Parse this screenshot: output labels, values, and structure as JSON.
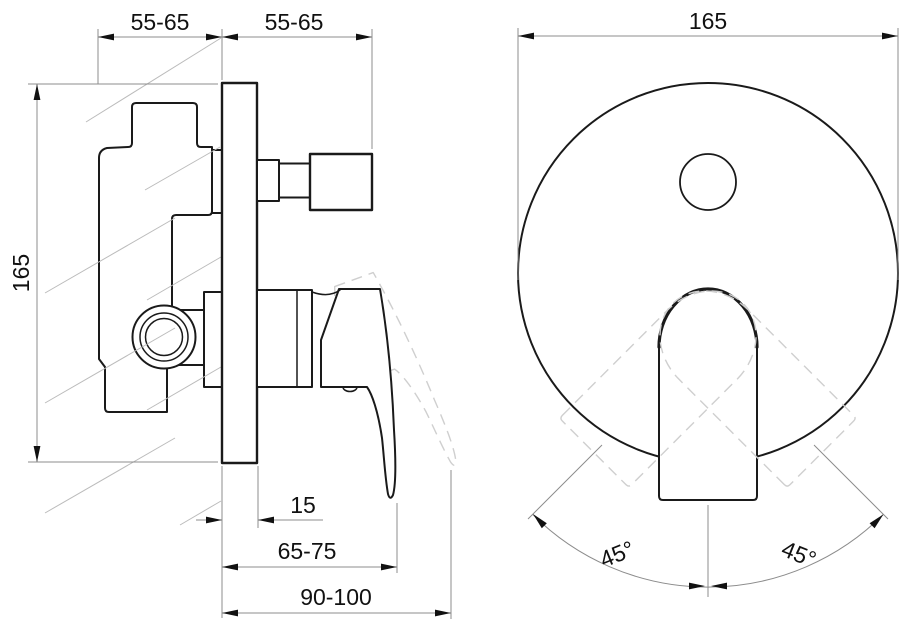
{
  "drawing": {
    "kind": "concealed-shower-mixer-installation-drawing",
    "side_view": {
      "dim_depth_behind_wall": "55-65",
      "dim_depth_in_front": "55-65",
      "dim_plate_height": "165",
      "dim_plate_offset": "15",
      "dim_lever_reach_closed": "65-75",
      "dim_lever_reach_open": "90-100"
    },
    "front_view": {
      "dim_plate_diameter": "165",
      "dim_swing_left": "45°",
      "dim_swing_right": "45°"
    },
    "colors": {
      "background": "#ffffff",
      "outline": "#1a1a1a",
      "dimension_line": "#8c8c8c",
      "hatch_line": "#bbbbbb",
      "dashed_alt_position": "#cfcfcf",
      "text": "#111111"
    }
  }
}
